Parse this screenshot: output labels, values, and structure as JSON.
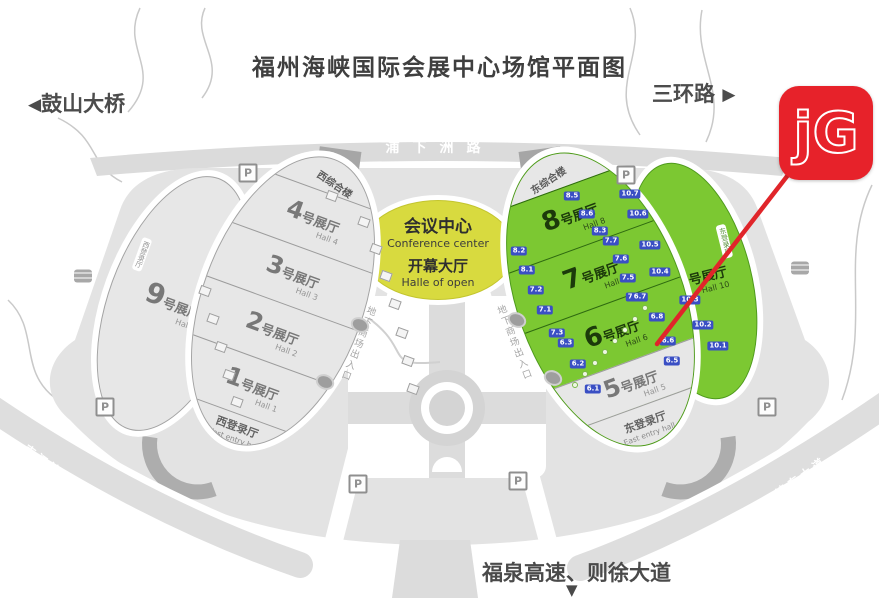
{
  "title": "福州海峡国际会展中心场馆平面图",
  "arrows": {
    "west": "◀",
    "east": "▶",
    "south": "▼"
  },
  "directions": {
    "west": "鼓山大桥",
    "east": "三环路",
    "south": "福泉高速、则徐大道"
  },
  "roads": {
    "north": "浦下洲路",
    "southwest": "南江滨东大道",
    "southeast": "南江滨东大道"
  },
  "underground": "地下商场出入口",
  "logo": {
    "text": "jG",
    "bg": "#e7222a"
  },
  "conference": {
    "zh": "会议中心",
    "en": "Conference center",
    "hall_zh": "开幕大厅",
    "hall_en": "Halle of open"
  },
  "west_wing": {
    "cap": "西综合楼",
    "halls": [
      {
        "num": "4",
        "suffix": "号展厅",
        "en": "Hall 4"
      },
      {
        "num": "3",
        "suffix": "号展厅",
        "en": "Hall 3"
      },
      {
        "num": "2",
        "suffix": "号展厅",
        "en": "Hall 2"
      },
      {
        "num": "1",
        "suffix": "号展厅",
        "en": "Hall 1"
      }
    ],
    "entry_zh": "西登录厅",
    "entry_en": "West entry hall"
  },
  "east_wing": {
    "cap": "东综合楼",
    "halls": [
      {
        "num": "8",
        "suffix": "号展厅",
        "en": "Hall 8"
      },
      {
        "num": "7",
        "suffix": "号展厅",
        "en": "Hall 7"
      },
      {
        "num": "6",
        "suffix": "号展厅",
        "en": "Hall 6"
      },
      {
        "num": "5",
        "suffix": "号展厅",
        "en": "Hall 5"
      }
    ],
    "entry_zh": "东登录厅",
    "entry_en": "East entry hall"
  },
  "hall9": {
    "num": "9",
    "suffix": "号展厅",
    "en": "Hall 9",
    "side": "西登录厅"
  },
  "hall10": {
    "num": "10",
    "suffix": "号展厅",
    "en": "Hall 10",
    "side": "东登录厅"
  },
  "markers": {
    "parking_label": "P",
    "parking": [
      [
        248,
        173
      ],
      [
        626,
        175
      ],
      [
        105,
        407
      ],
      [
        767,
        407
      ],
      [
        358,
        484
      ],
      [
        518,
        481
      ]
    ],
    "bus": [
      [
        83,
        276
      ],
      [
        800,
        268
      ]
    ],
    "gates": [
      {
        "t": "8.5",
        "x": 572,
        "y": 196
      },
      {
        "t": "8.6",
        "x": 587,
        "y": 214
      },
      {
        "t": "8.3",
        "x": 600,
        "y": 231
      },
      {
        "t": "8.2",
        "x": 519,
        "y": 251
      },
      {
        "t": "8.1",
        "x": 527,
        "y": 270
      },
      {
        "t": "7.7",
        "x": 611,
        "y": 241
      },
      {
        "t": "7.6",
        "x": 621,
        "y": 259
      },
      {
        "t": "7.5",
        "x": 628,
        "y": 278
      },
      {
        "t": "7.4",
        "x": 634,
        "y": 297
      },
      {
        "t": "7.2",
        "x": 536,
        "y": 290
      },
      {
        "t": "7.1",
        "x": 545,
        "y": 310
      },
      {
        "t": "7.3",
        "x": 557,
        "y": 333
      },
      {
        "t": "6.7",
        "x": 640,
        "y": 297
      },
      {
        "t": "6.8",
        "x": 657,
        "y": 317
      },
      {
        "t": "6.6",
        "x": 668,
        "y": 341
      },
      {
        "t": "6.5",
        "x": 672,
        "y": 361
      },
      {
        "t": "6.3",
        "x": 566,
        "y": 343
      },
      {
        "t": "6.2",
        "x": 578,
        "y": 364
      },
      {
        "t": "6.1",
        "x": 593,
        "y": 389
      },
      {
        "t": "10.7",
        "x": 630,
        "y": 194
      },
      {
        "t": "10.6",
        "x": 638,
        "y": 214
      },
      {
        "t": "10.5",
        "x": 650,
        "y": 245
      },
      {
        "t": "10.4",
        "x": 660,
        "y": 272
      },
      {
        "t": "10.3",
        "x": 690,
        "y": 300
      },
      {
        "t": "10.2",
        "x": 703,
        "y": 325
      },
      {
        "t": "10.1",
        "x": 718,
        "y": 346
      }
    ],
    "doors": [
      [
        364,
        222
      ],
      [
        376,
        249
      ],
      [
        386,
        276
      ],
      [
        395,
        304
      ],
      [
        402,
        333
      ],
      [
        408,
        361
      ],
      [
        413,
        389
      ],
      [
        205,
        291
      ],
      [
        213,
        319
      ],
      [
        221,
        347
      ],
      [
        229,
        375
      ],
      [
        237,
        402
      ],
      [
        332,
        196
      ]
    ],
    "trees": [
      [
        360,
        325
      ],
      [
        325,
        382
      ],
      [
        517,
        320
      ],
      [
        553,
        378
      ]
    ],
    "dots": [
      [
        575,
        385
      ],
      [
        585,
        374
      ],
      [
        595,
        363
      ],
      [
        605,
        352
      ],
      [
        615,
        341
      ],
      [
        625,
        330
      ],
      [
        635,
        319
      ],
      [
        645,
        308
      ]
    ]
  }
}
